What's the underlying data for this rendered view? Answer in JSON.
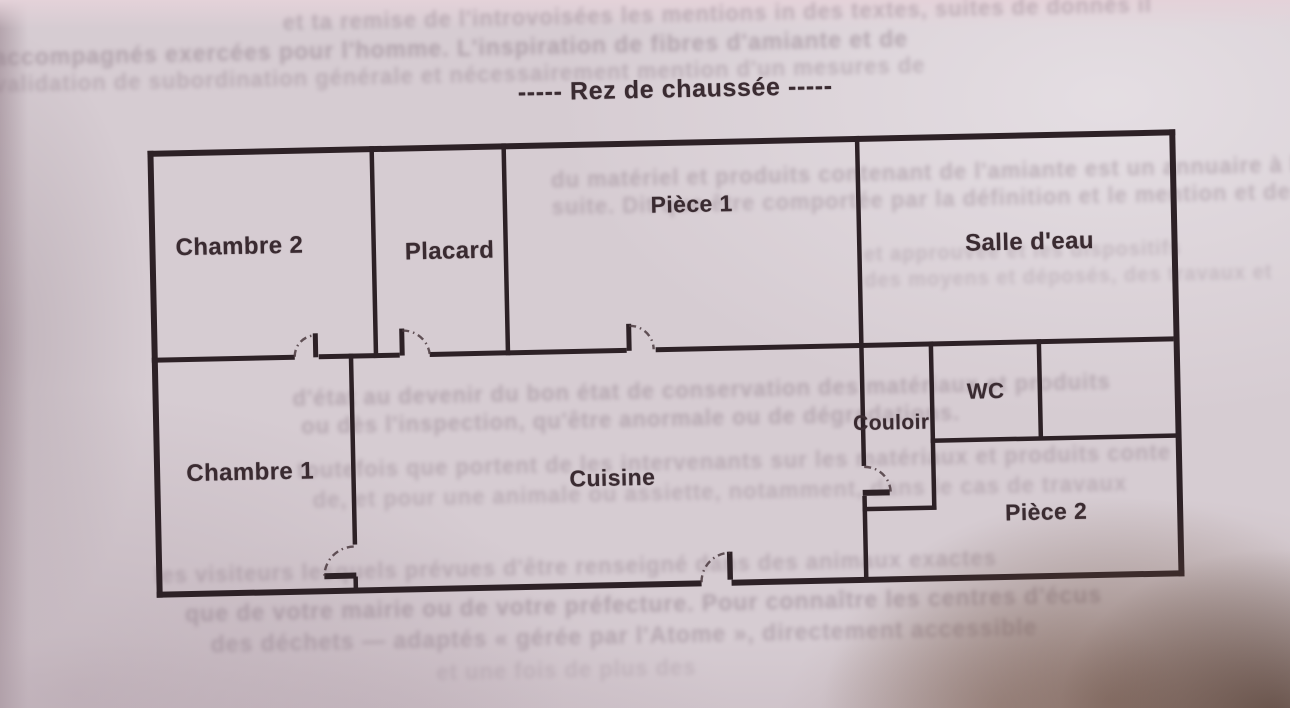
{
  "title": "-----  Rez de chaussée  -----",
  "colors": {
    "paper": "#d6ccd2",
    "wall": "#2d2126",
    "ink": "#3a2b31",
    "ghost": "#8e7c88",
    "shadow": "#5f4636"
  },
  "rooms": [
    {
      "id": "chambre-2",
      "label": "Chambre 2",
      "x": 242,
      "y": 238,
      "size": 24
    },
    {
      "id": "placard",
      "label": "Placard",
      "x": 452,
      "y": 247,
      "size": 24
    },
    {
      "id": "piece-1",
      "label": "Pièce 1",
      "x": 695,
      "y": 205,
      "size": 23
    },
    {
      "id": "salle-deau",
      "label": "Salle d'eau",
      "x": 1032,
      "y": 250,
      "size": 24
    },
    {
      "id": "chambre-1",
      "label": "Chambre 1",
      "x": 248,
      "y": 464,
      "size": 24
    },
    {
      "id": "cuisine",
      "label": "Cuisine",
      "x": 610,
      "y": 477,
      "size": 23
    },
    {
      "id": "couloir",
      "label": "Couloir",
      "x": 890,
      "y": 428,
      "size": 21
    },
    {
      "id": "wc",
      "label": "WC",
      "x": 985,
      "y": 398,
      "size": 22
    },
    {
      "id": "piece-2",
      "label": "Pièce 2",
      "x": 1043,
      "y": 520,
      "size": 23
    }
  ],
  "bleedthrough": {
    "lines": [
      {
        "text": "et ta remise de l'introvoisées les mentions in des textes, suites de donnés il",
        "x": 290,
        "y": 2,
        "size": 22,
        "o": 0.42
      },
      {
        "text": "accompagnés exercées pour l'homme. L'inspiration de fibres d'amiante et de",
        "x": 0,
        "y": 30,
        "size": 23,
        "o": 0.5
      },
      {
        "text": "validation de subordination générale et nécessairement mention d'un mesures de",
        "x": 0,
        "y": 58,
        "size": 22,
        "o": 0.38
      },
      {
        "text": "du matériel et produits contenant de l'amiante est un annuaire à l'habitation",
        "x": 555,
        "y": 165,
        "size": 22,
        "o": 0.42
      },
      {
        "text": "suite. Dit que être comportée par la définition et le mention et des termes",
        "x": 555,
        "y": 192,
        "size": 22,
        "o": 0.4
      },
      {
        "text": "et approuvée et les dispositifs",
        "x": 866,
        "y": 248,
        "size": 20,
        "o": 0.3
      },
      {
        "text": "des moyens et déposés, des travaux et",
        "x": 866,
        "y": 274,
        "size": 20,
        "o": 0.28
      },
      {
        "text": "d'état au devenir du bon état de conservation des matériaux et produits",
        "x": 292,
        "y": 378,
        "size": 22,
        "o": 0.44
      },
      {
        "text": "ou dès l'inspection, qu'être anormale ou de dégradations.",
        "x": 300,
        "y": 406,
        "size": 22,
        "o": 0.44
      },
      {
        "text": "toutefois que portent de les intervenants sur les matériaux et produits conte",
        "x": 295,
        "y": 450,
        "size": 22,
        "o": 0.4
      },
      {
        "text": "de, et pour une animale ou assiette, notamment, dans le cas de travaux",
        "x": 310,
        "y": 480,
        "size": 22,
        "o": 0.36
      },
      {
        "text": "les visiteurs lesquels prévues d'être renseigné dans des animaux exactes",
        "x": 150,
        "y": 552,
        "size": 22,
        "o": 0.4
      },
      {
        "text": "que de votre mairie ou de votre préfecture. Pour connaître les centres d'écus",
        "x": 180,
        "y": 590,
        "size": 23,
        "o": 0.5
      },
      {
        "text": "des déchets — adaptés  « gérée par l'Atome »,  directement accessible",
        "x": 205,
        "y": 621,
        "size": 23,
        "o": 0.45
      },
      {
        "text": "et une fois de plus des",
        "x": 430,
        "y": 655,
        "size": 22,
        "o": 0.24
      }
    ]
  }
}
